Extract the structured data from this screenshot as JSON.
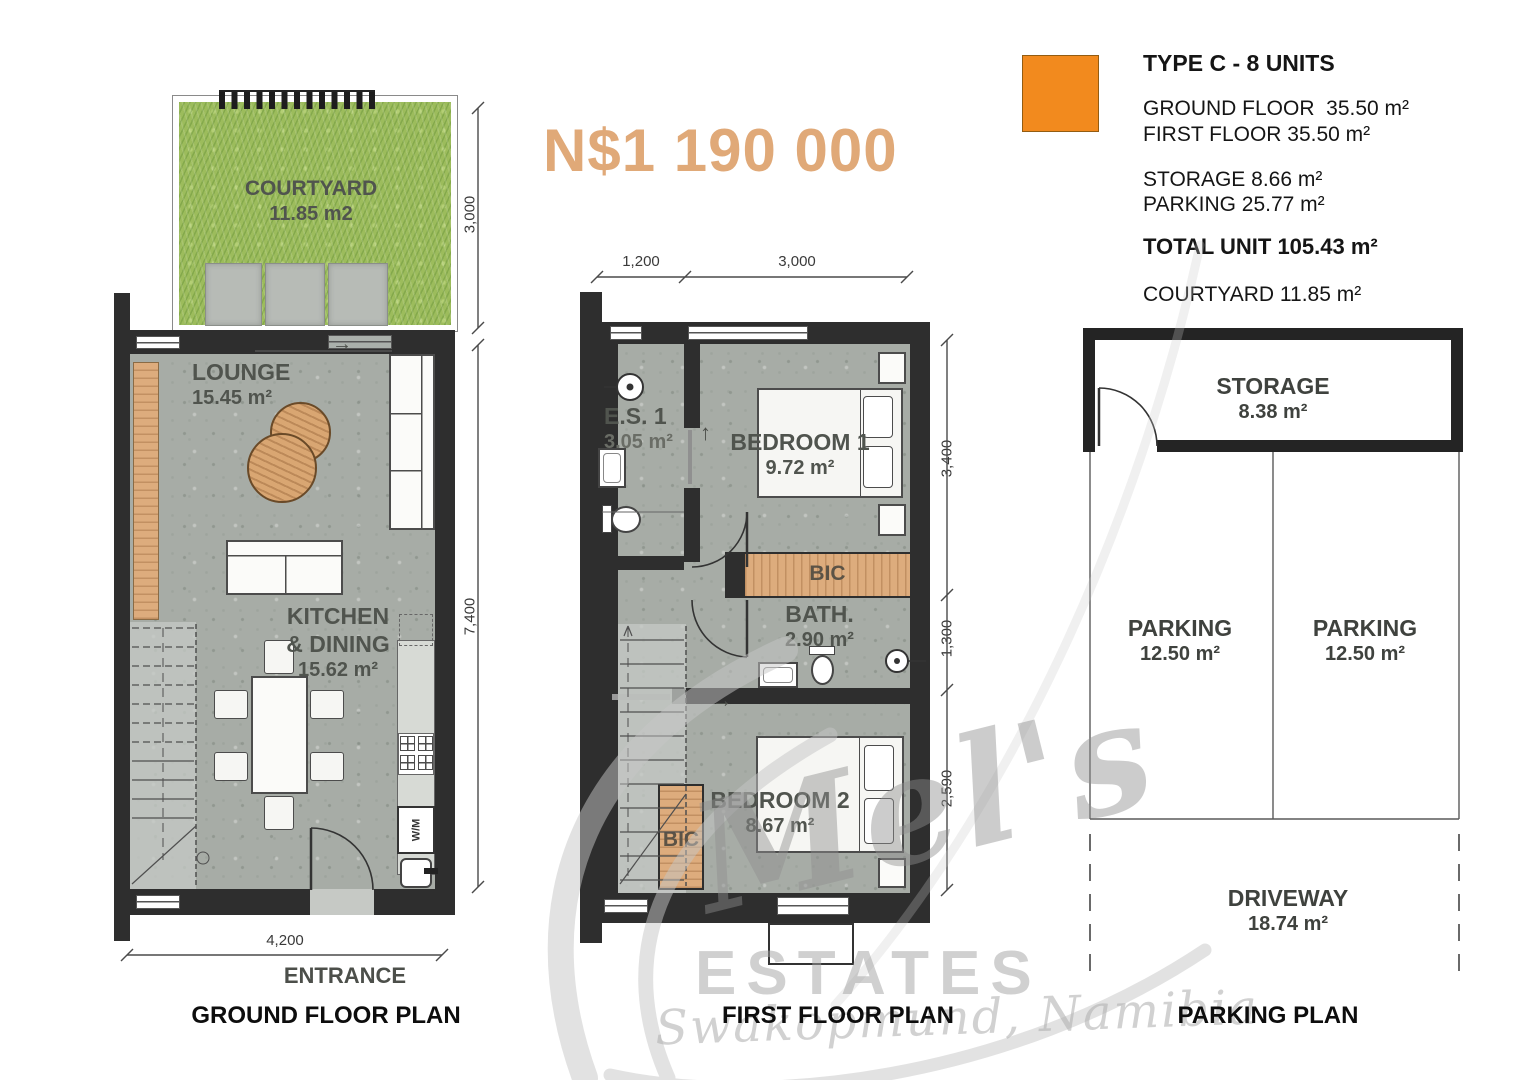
{
  "colors": {
    "accent_orange": "#F28A1E",
    "price_tan": "#E0A978",
    "wall_dark": "#2E2E2E",
    "grass_green": "#9CBC5C",
    "wood_tan": "#DDAC7D",
    "concrete_gray": "#A7ACA6"
  },
  "price": "N$1 190 000",
  "legend": {
    "title": "TYPE C - 8 UNITS",
    "ground_floor": "GROUND FLOOR  35.50 m²",
    "first_floor": "FIRST FLOOR 35.50 m²",
    "storage": "STORAGE 8.66 m²",
    "parking": "PARKING 25.77 m²",
    "total": "TOTAL UNIT 105.43 m²",
    "courtyard": "COURTYARD 11.85 m²"
  },
  "ground_floor": {
    "title": "GROUND FLOOR PLAN",
    "entrance": "ENTRANCE",
    "courtyard_name": "COURTYARD",
    "courtyard_area": "11.85 m2",
    "lounge_name": "LOUNGE",
    "lounge_area": "15.45 m²",
    "kitchen_line1": "KITCHEN",
    "kitchen_line2": "& DINING",
    "kitchen_area": "15.62 m²",
    "wm_label": "W/M",
    "dim_courtyard": "3,000",
    "dim_height": "7,400",
    "dim_width": "4,200"
  },
  "first_floor": {
    "title": "FIRST FLOOR PLAN",
    "es1_name": "E.S. 1",
    "es1_area": "3.05 m²",
    "bedroom1_name": "BEDROOM 1",
    "bedroom1_area": "9.72 m²",
    "bic1": "BIC",
    "bath_name": "BATH.",
    "bath_area": "2.90 m²",
    "bedroom2_name": "BEDROOM 2",
    "bedroom2_area": "8.67 m²",
    "bic2": "BIC",
    "dim_top_left": "1,200",
    "dim_top_right": "3,000",
    "dim_right_top": "3,400",
    "dim_right_mid": "1,300",
    "dim_right_bottom": "2,590"
  },
  "parking_plan": {
    "title": "PARKING PLAN",
    "storage_name": "STORAGE",
    "storage_area": "8.38 m²",
    "parking_left_name": "PARKING",
    "parking_left_area": "12.50 m²",
    "parking_right_name": "PARKING",
    "parking_right_area": "12.50 m²",
    "driveway_name": "DRIVEWAY",
    "driveway_area": "18.74 m²"
  },
  "watermark": {
    "script_name": "Mel's",
    "estates": "ESTATES",
    "location": "Swakopmund, Namibia"
  },
  "icons": {
    "arrow_right": "→",
    "arrow_up": "↑"
  }
}
